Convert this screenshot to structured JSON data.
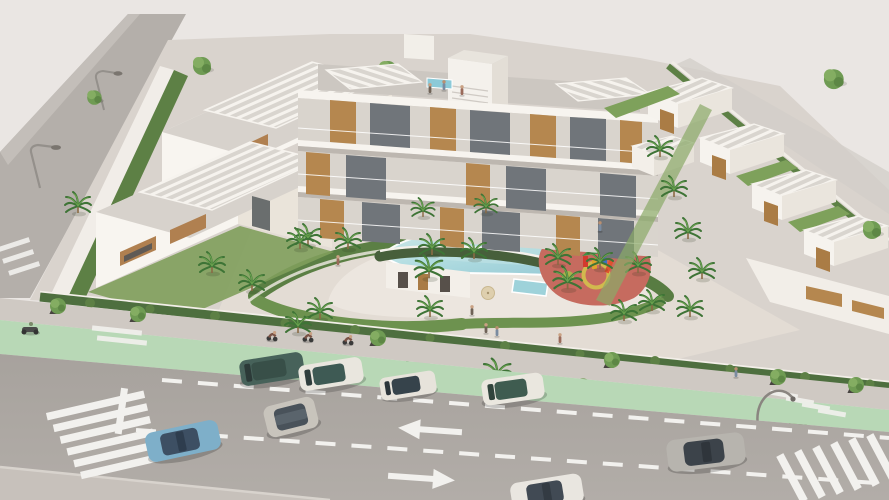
{
  "meta": {
    "type": "3d-architectural-aerial-render",
    "description": "Aerial 3D architectural rendering of a white residential complex with rooftop pergolas, a curved communal swimming pool, pool pavilion, red playground, landscaped courtyard with palm trees, fronted by a sidewalk, a green bike lane and a two-way road with parked and moving cars, crosswalks and lane arrows."
  },
  "palette": {
    "sky_background": "#eae6e3",
    "site_paving": "#d9d3cd",
    "courtyard_deck": "#e7e1d9",
    "building_white": "#f7f4ef",
    "building_shadow_face": "#eae4da",
    "roof_gray": "#d7d2cc",
    "pergola_slat": "#f6f3ee",
    "wood_accent": "#b5874f",
    "glass_dark": "#70757a",
    "hedge_dark_green": "#4e6f3f",
    "bush_green": "#5d8045",
    "lawn_green": "#7f9f5c",
    "palm_frond": "#3e7436",
    "pool_water_light": "#cdeaec",
    "pool_water_deep": "#8fc6d2",
    "pool_house_roof": "#475f3b",
    "playground_rubber": "#c66b5f",
    "playground_circle_yellow": "#d2b94e",
    "bike_lane_green": "#b8d8b6",
    "sidewalk_gray": "#cfc9c3",
    "road_asphalt": "#aaa5a0",
    "road_marking_white": "#f2f1ee"
  },
  "scene": {
    "buildings": [
      {
        "name": "left-villa-block",
        "units": 2,
        "features": [
          "rooftop slat pergolas",
          "wood window panels",
          "perimeter wall with hedge"
        ]
      },
      {
        "name": "central-apartment-building",
        "floors": 3,
        "features": [
          "white balcony slabs",
          "wood cladding panels",
          "central stair tower",
          "rooftop terrace with small pool",
          "roof pergolas"
        ]
      },
      {
        "name": "right-townhouse-row",
        "units": 5,
        "features": [
          "slat pergola roofs",
          "wood stair accents",
          "lawn strips"
        ]
      },
      {
        "name": "pool-pavilion",
        "features": [
          "curved green planted roof",
          "white walls"
        ]
      }
    ],
    "amenities": [
      {
        "name": "main-pool",
        "shape": "curved kidney",
        "color": "light blue"
      },
      {
        "name": "kids-pool",
        "shape": "small rectangle"
      },
      {
        "name": "playground",
        "surface": "red rubber with yellow circles",
        "equipment": "multicolor play structure"
      },
      {
        "name": "sun-loungers",
        "count": 3
      },
      {
        "name": "umbrella",
        "count": 1
      }
    ],
    "infrastructure": {
      "road": {
        "lanes": 3,
        "dashed_lines": 2,
        "arrows": [
          {
            "direction": "left"
          },
          {
            "direction": "right"
          }
        ],
        "crosswalks": 2,
        "stop_line": 1
      },
      "bike_lane": {
        "color": "pale green",
        "markings": [
          "double bars left",
          "ladder crossing right"
        ]
      },
      "sidewalk": {
        "street_trees_in_planters": 10
      },
      "street_lamps": 3,
      "side_street": {
        "position": "upper left",
        "crosswalk": 1
      }
    },
    "vehicles": [
      {
        "type": "suv",
        "color": "dark teal",
        "state": "parked"
      },
      {
        "type": "car",
        "color": "white with dark teal roof",
        "state": "parked"
      },
      {
        "type": "car",
        "color": "white with dark roof",
        "state": "parked"
      },
      {
        "type": "car",
        "color": "white with green roof",
        "state": "parked"
      },
      {
        "type": "car",
        "color": "light blue",
        "state": "driving"
      },
      {
        "type": "hatchback",
        "color": "gray with dark roof",
        "state": "driving"
      },
      {
        "type": "sedan",
        "color": "gray with dark roof",
        "state": "driving"
      },
      {
        "type": "car",
        "color": "white with dark roof",
        "state": "driving"
      },
      {
        "type": "scooter",
        "color": "dark gray",
        "state": "on bike lane"
      }
    ],
    "people": {
      "cyclists": 4,
      "sidewalk_pedestrians": 5,
      "rooftop_people": 3,
      "courtyard_people": 3
    },
    "vegetation": {
      "palm_trees": 26,
      "round_trees": 12,
      "hedges": "curved hedge ring around pool and perimeter hedges"
    }
  }
}
